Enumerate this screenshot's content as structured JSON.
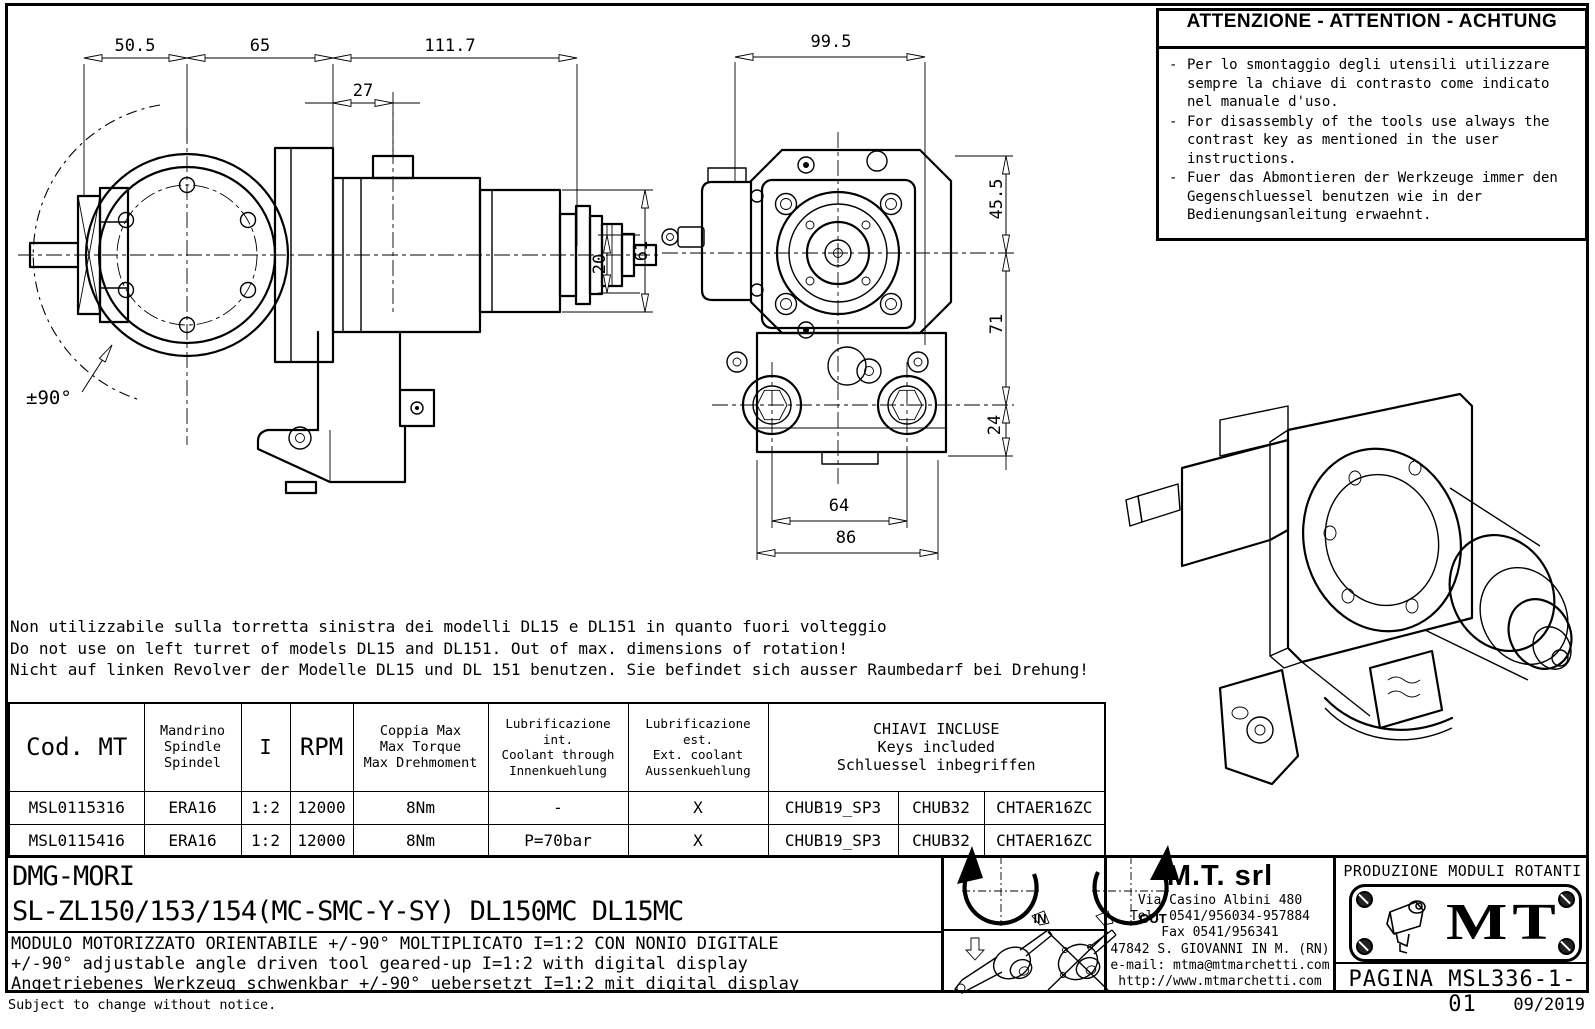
{
  "warning": {
    "title": "ATTENZIONE - ATTENTION - ACHTUNG",
    "items": [
      "Per lo smontaggio degli utensili utilizzare sempre la chiave di contrasto come indicato nel manuale d'uso.",
      "For disassembly of the tools use always the contrast key as mentioned in the user instructions.",
      "Fuer das Abmontieren der Werkzeuge immer den Gegenschluessel benutzen wie in der Bedienungsanleitung erwaehnt."
    ]
  },
  "notes": {
    "it": "Non utilizzabile sulla torretta sinistra dei modelli DL15 e DL151 in quanto fuori volteggio",
    "en": "Do not use on left turret of models DL15 and DL151. Out of max. dimensions of rotation!",
    "de": "Nicht auf linken Revolver der Modelle DL15 und DL 151 benutzen. Sie befindet sich ausser Raumbedarf bei Drehung!"
  },
  "side_view": {
    "dim_50_5": "50.5",
    "dim_65": "65",
    "dim_111_7": "111.7",
    "dim_27": "27",
    "dim_61": "61",
    "dim_20": "20",
    "angle": "±90°"
  },
  "front_view": {
    "dim_99_5": "99.5",
    "dim_45_5": "45.5",
    "dim_71": "71",
    "dim_24": "24",
    "dim_64": "64",
    "dim_86": "86"
  },
  "table": {
    "headers": {
      "cod": "Cod. MT",
      "mandrino": [
        "Mandrino",
        "Spindle",
        "Spindel"
      ],
      "ratio": "I",
      "rpm": "RPM",
      "torque": [
        "Coppia Max",
        "Max Torque",
        "Max Drehmoment"
      ],
      "lub_int": [
        "Lubrificazione int.",
        "Coolant through",
        "Innenkuehlung"
      ],
      "lub_est": [
        "Lubrificazione est.",
        "Ext. coolant",
        "Aussenkuehlung"
      ],
      "keys": [
        "CHIAVI INCLUSE",
        "Keys included",
        "Schluessel inbegriffen"
      ]
    },
    "rows": [
      {
        "cells": [
          "MSL0115316",
          "ERA16",
          "1:2",
          "12000",
          "8Nm",
          "-",
          "X",
          "CHUB19_SP3",
          "CHUB32",
          "CHTAER16ZC"
        ]
      },
      {
        "cells": [
          "MSL0115416",
          "ERA16",
          "1:2",
          "12000",
          "8Nm",
          "P=70bar",
          "X",
          "CHUB19_SP3",
          "CHUB32",
          "CHTAER16ZC"
        ]
      }
    ]
  },
  "title_block": {
    "brand": "DMG-MORI",
    "models": "SL-ZL150/153/154(MC-SMC-Y-SY)  DL150MC  DL15MC",
    "desc_it": "MODULO MOTORIZZATO ORIENTABILE +/-90° MOLTIPLICATO I=1:2 CON NONIO DIGITALE",
    "desc_en": "+/-90° adjustable angle driven tool geared-up I=1:2 with digital display",
    "desc_de": "Angetriebenes Werkzeug schwenkbar +/-90° uebersetzt I=1:2 mit digital display",
    "symbols": {
      "in": "IN",
      "out": "OUT"
    },
    "company": {
      "name": "M.T. srl",
      "address": "Via Casino Albini 480",
      "tel": "Tel. 0541/956034-957884",
      "fax": "Fax 0541/956341",
      "city": "47842 S. GIOVANNI IN M. (RN)",
      "email": "e-mail: mtma@mtmarchetti.com",
      "web": "http://www.mtmarchetti.com"
    },
    "logo": {
      "caption": "PRODUZIONE MODULI ROTANTI",
      "monogram": "MT",
      "page": "PAGINA MSL336-1-01"
    }
  },
  "footer": {
    "disclaimer": "Subject to change without notice.",
    "date": "09/2019"
  }
}
